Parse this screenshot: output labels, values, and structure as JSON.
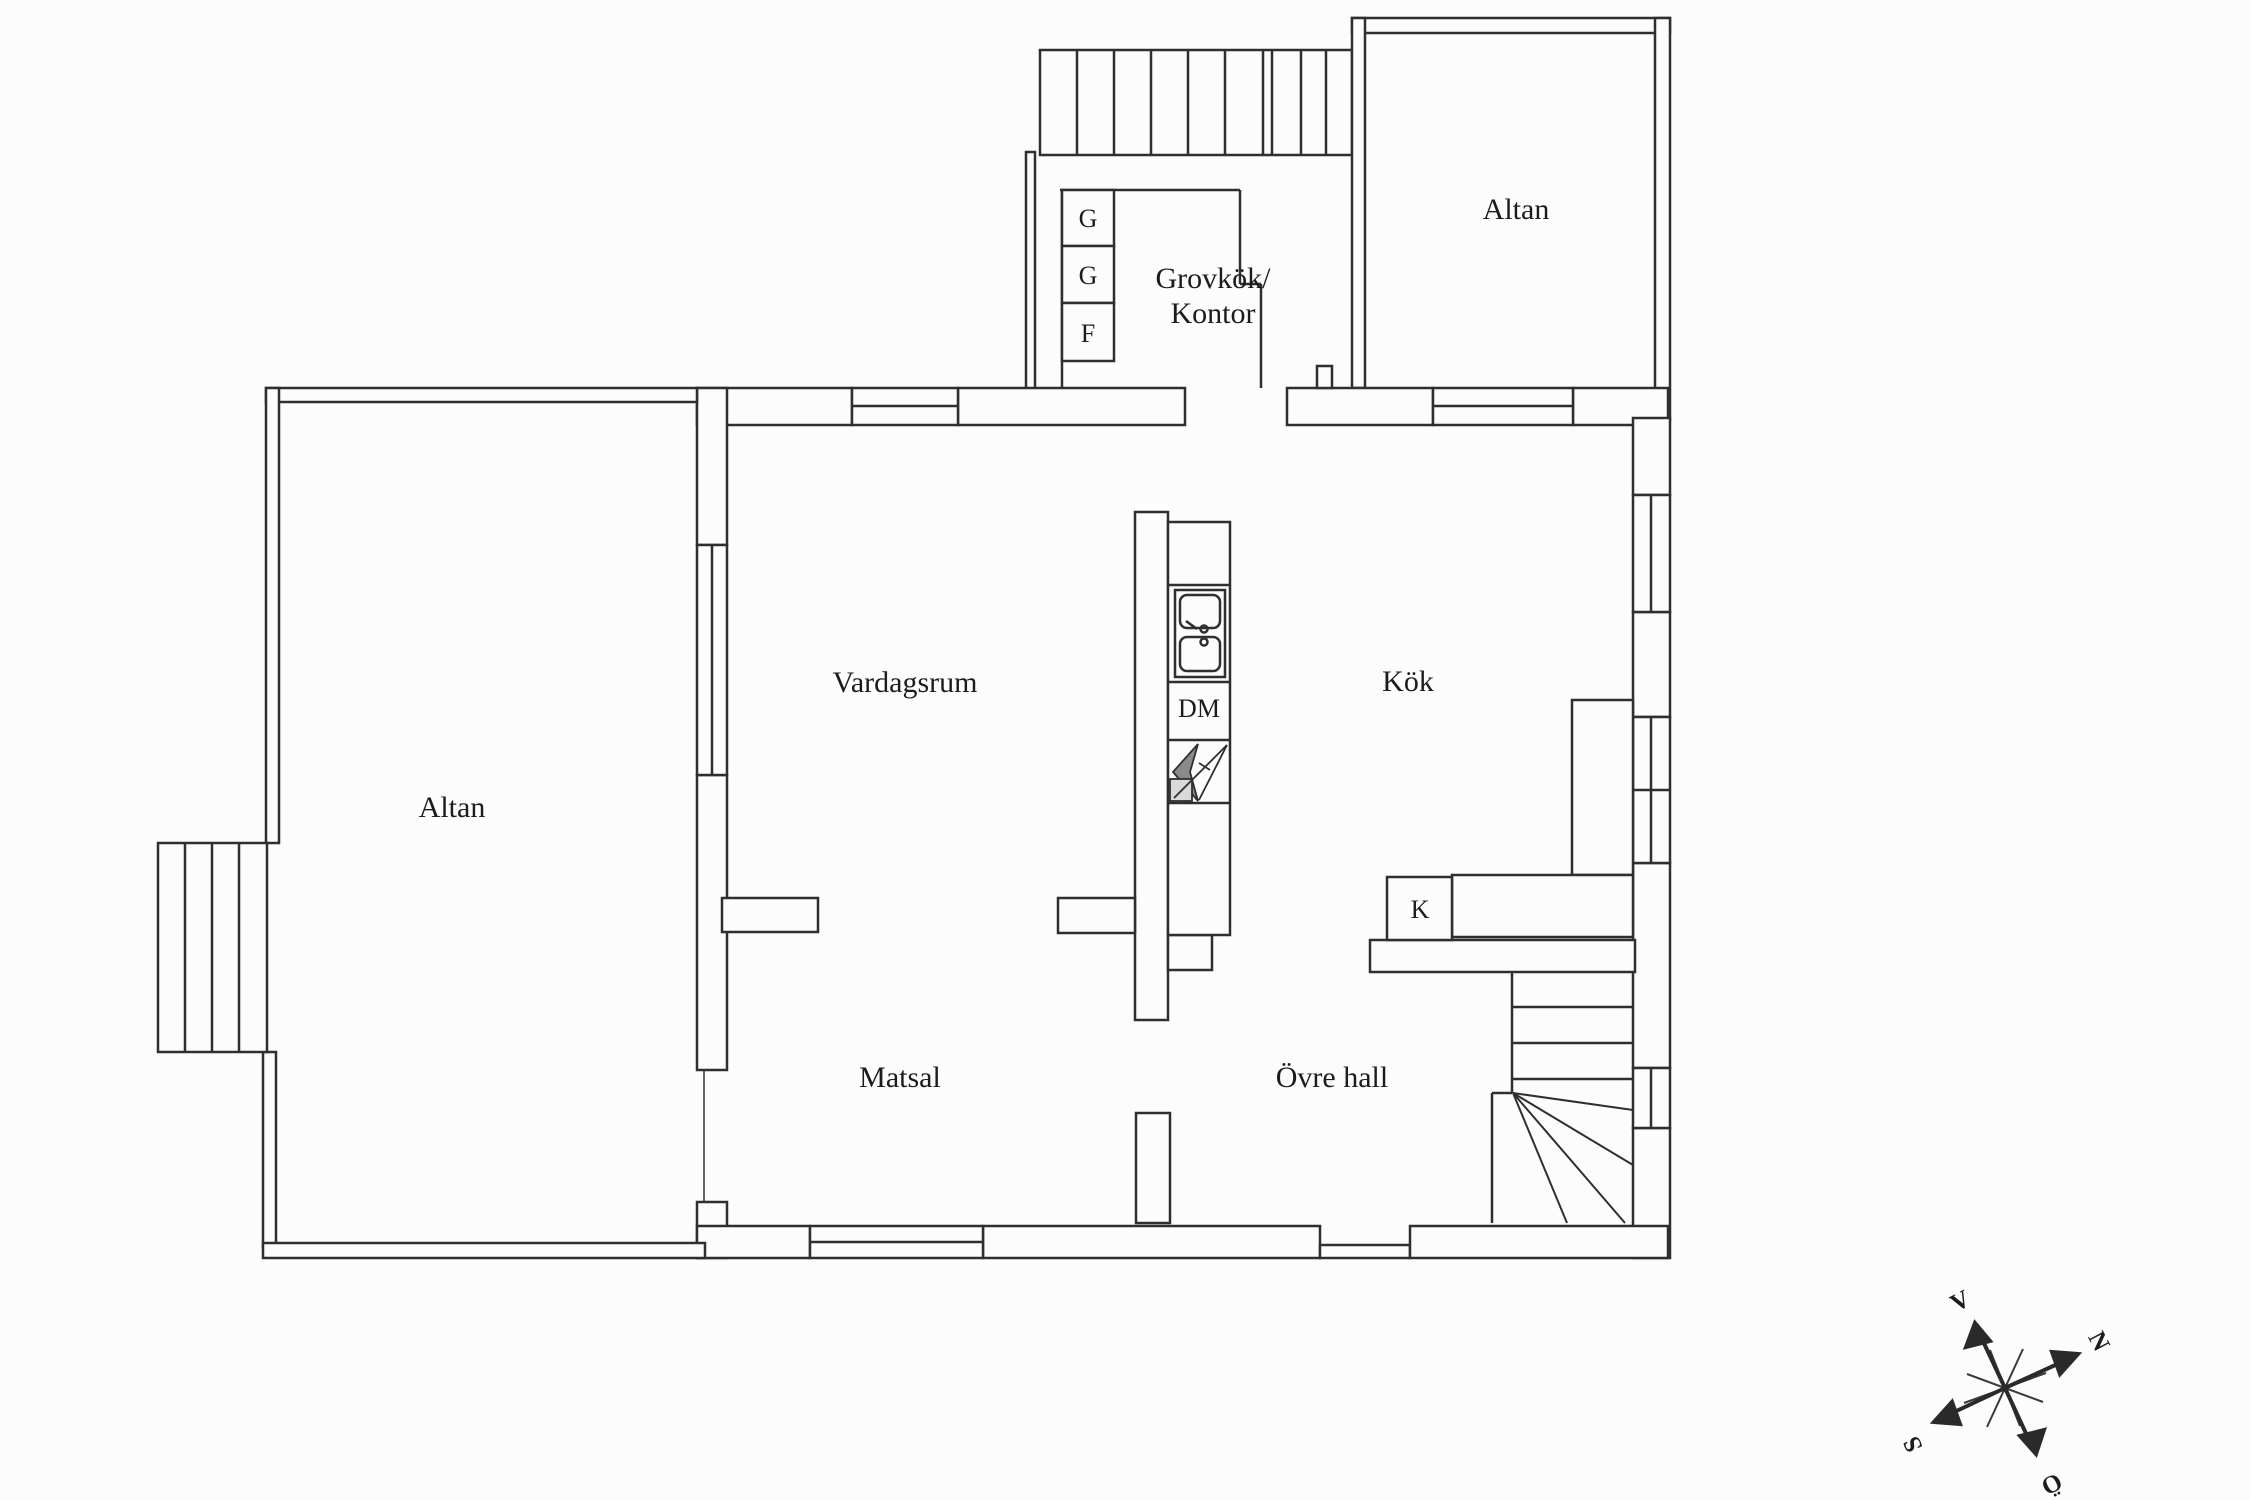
{
  "page": {
    "background": "#fcfcfc",
    "line_color": "#2f2f2f",
    "text_color": "#1c1c1c",
    "fan_dark": "#8a8a8a",
    "fan_light": "#d9d9d9"
  },
  "rooms": {
    "altan_left": "Altan",
    "altan_top_right": "Altan",
    "grovkok_line1": "Grovkök/",
    "grovkok_line2": "Kontor",
    "vardagsrum": "Vardagsrum",
    "kok": "Kök",
    "matsal": "Matsal",
    "ovre_hall": "Övre hall"
  },
  "fixtures": {
    "cabinet_g1": "G",
    "cabinet_g2": "G",
    "cabinet_f": "F",
    "dishwasher": "DM",
    "fridge": "K"
  },
  "compass": {
    "north": "N",
    "west": "V",
    "south": "S",
    "east": "Ö"
  }
}
